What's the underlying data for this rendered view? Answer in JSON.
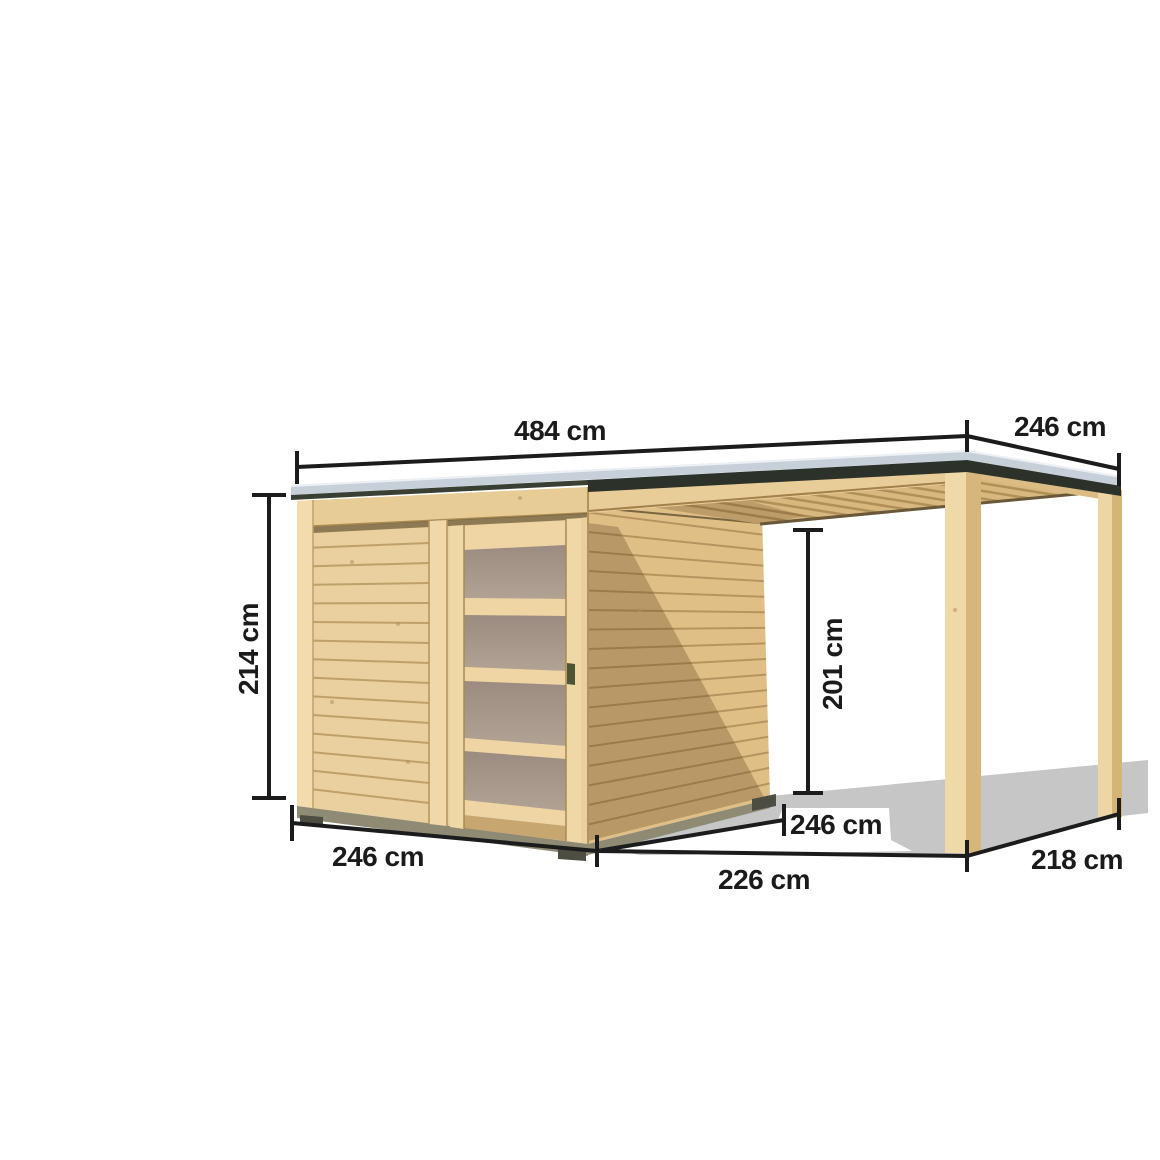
{
  "page": {
    "background": "#ffffff",
    "width": 1160,
    "height": 1160
  },
  "illustration": {
    "name": "garden-shed-with-side-canopy",
    "description": "Dimensioned product drawing of a flat-roof wooden garden shed with a sliding door of four translucent panels and an attached open canopy carried by two wooden posts under a shared roof"
  },
  "dimensions": [
    {
      "id": "roof-total-width",
      "label": "484 cm"
    },
    {
      "id": "roof-depth",
      "label": "246 cm"
    },
    {
      "id": "wall-height",
      "label": "214 cm"
    },
    {
      "id": "canopy-clear-height",
      "label": "201 cm"
    },
    {
      "id": "shed-front-width",
      "label": "246 cm"
    },
    {
      "id": "shed-side-depth",
      "label": "246 cm"
    },
    {
      "id": "canopy-front-width",
      "label": "226 cm"
    },
    {
      "id": "canopy-side-depth",
      "label": "218 cm"
    }
  ],
  "colors": {
    "background": "#ffffff",
    "wood_light": "#eccf9c",
    "wood_face": "#ead09e",
    "wood_medium": "#ddbb82",
    "wood_trim": "#f0d8a8",
    "wood_line": "#b3935c",
    "door_panel": "#a5948a",
    "door_handle": "#4c5534",
    "roof_top": "#c7d0d9",
    "roof_fascia": "#2c3129",
    "base_plinth": "#8e8a74",
    "foot_block": "#4e4d41",
    "ground_shadow": "#c6c6c6",
    "dimension_line": "#1c1c1c"
  }
}
